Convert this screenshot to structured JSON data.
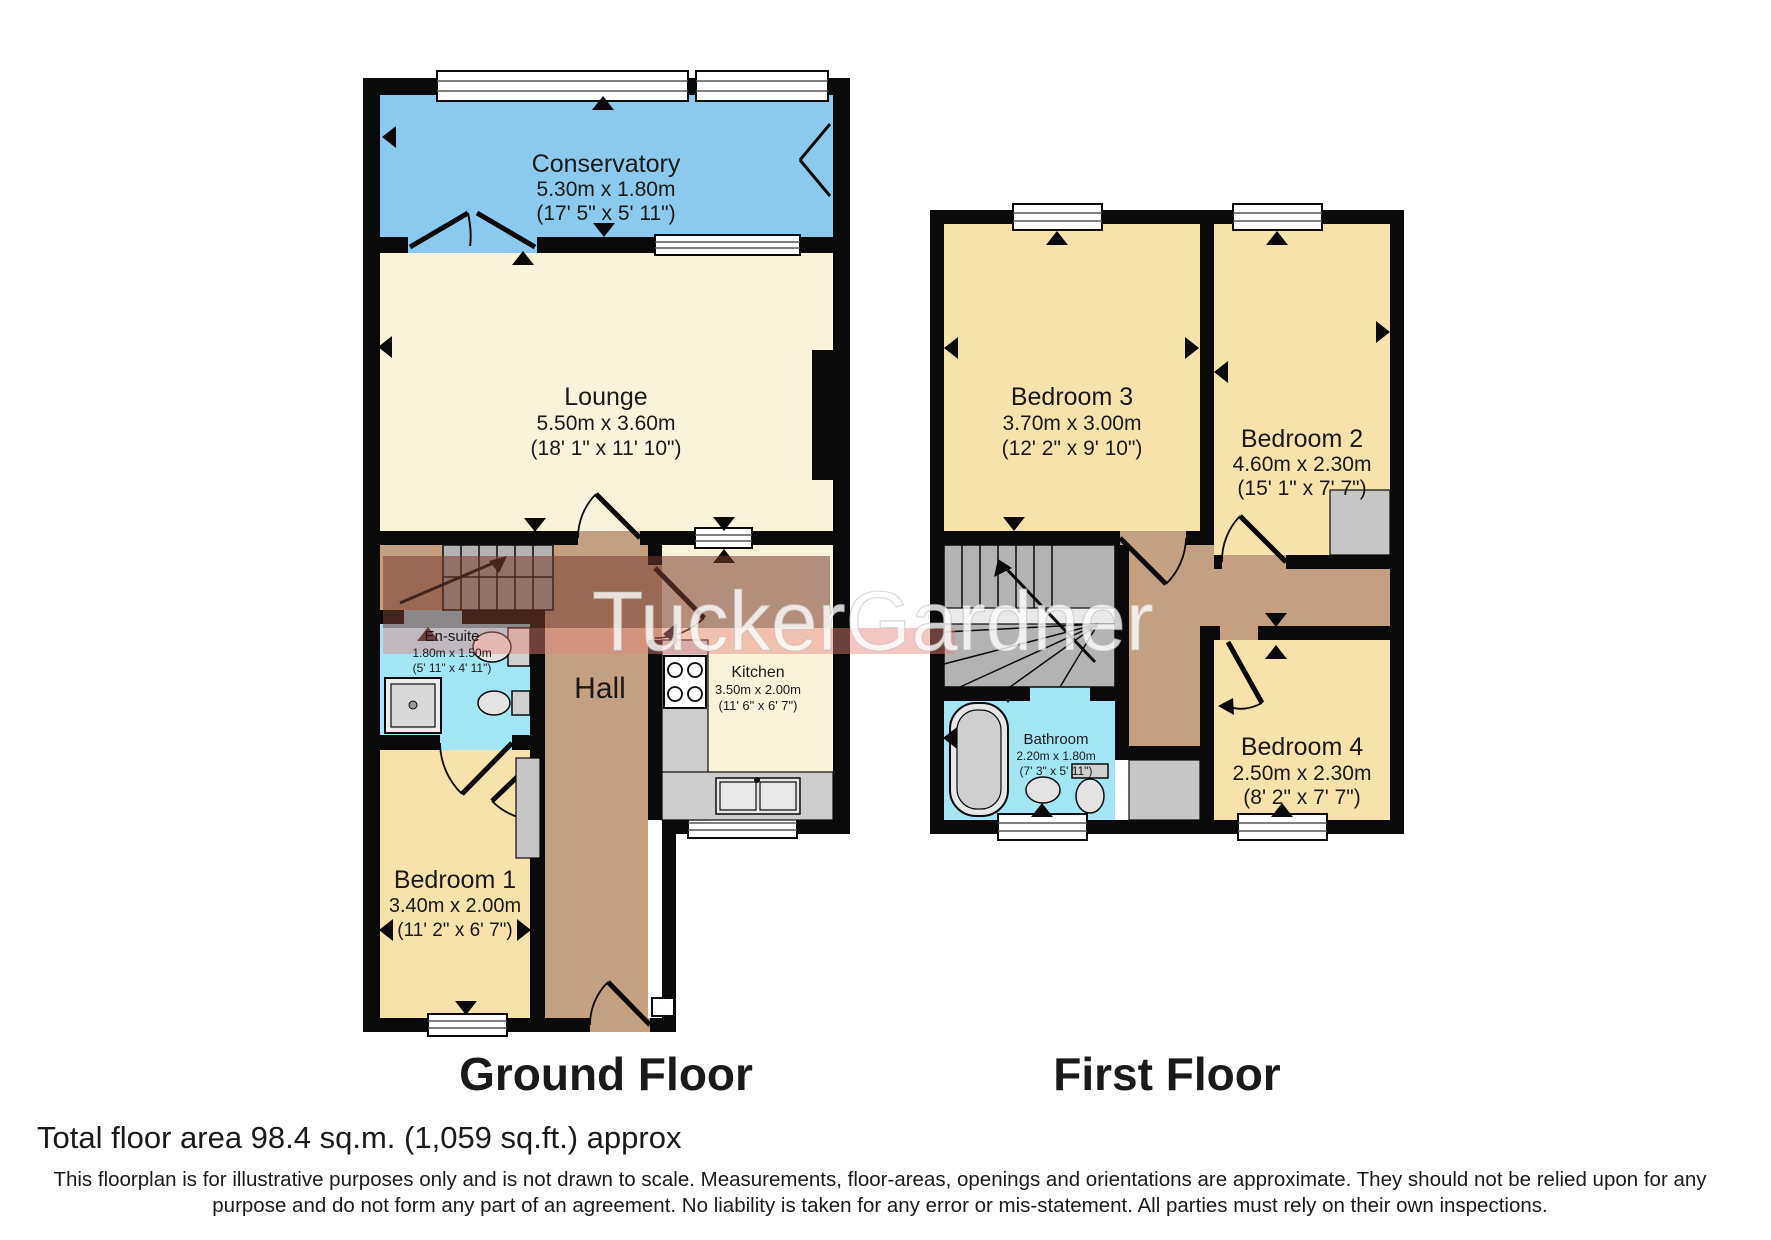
{
  "watermark": {
    "text": "TuckerGardner"
  },
  "ground": {
    "title": "Ground Floor",
    "rooms": {
      "conservatory": {
        "name": "Conservatory",
        "metric": "5.30m x 1.80m",
        "imperial": "(17' 5\" x 5' 11\")"
      },
      "lounge": {
        "name": "Lounge",
        "metric": "5.50m x 3.60m",
        "imperial": "(18' 1\" x 11' 10\")"
      },
      "hall": {
        "name": "Hall"
      },
      "ensuite": {
        "name": "En-suite",
        "metric": "1.80m x 1.50m",
        "imperial": "(5' 11\" x 4' 11\")"
      },
      "kitchen": {
        "name": "Kitchen",
        "metric": "3.50m x 2.00m",
        "imperial": "(11' 6\" x 6' 7\")"
      },
      "bedroom1": {
        "name": "Bedroom 1",
        "metric": "3.40m x 2.00m",
        "imperial": "(11' 2\" x 6' 7\")"
      }
    }
  },
  "first": {
    "title": "First Floor",
    "rooms": {
      "bedroom3": {
        "name": "Bedroom 3",
        "metric": "3.70m x 3.00m",
        "imperial": "(12' 2\" x 9' 10\")"
      },
      "bedroom2": {
        "name": "Bedroom 2",
        "metric": "4.60m x 2.30m",
        "imperial": "(15' 1\" x 7' 7\")"
      },
      "bathroom": {
        "name": "Bathroom",
        "metric": "2.20m x 1.80m",
        "imperial": "(7' 3\" x 5' 11\")"
      },
      "bedroom4": {
        "name": "Bedroom 4",
        "metric": "2.50m x 2.30m",
        "imperial": "(8' 2\" x 7' 7\")"
      }
    }
  },
  "footer": {
    "total_area": "Total floor area 98.4 sq.m. (1,059 sq.ft.) approx",
    "disclaimer_line1": "This floorplan is for illustrative purposes only and is not drawn to scale. Measurements, floor-areas, openings and orientations are approximate. They should not be relied upon for any",
    "disclaimer_line2": "purpose and do not form any part of an agreement. No liability is taken for any error or mis-statement. All parties must rely on their own inspections."
  },
  "colors": {
    "wall": "#0a0a0a",
    "conservatory_blue": "#8bc9ee",
    "living_cream": "#faf3dc",
    "bedroom_yellow": "#f6e2ab",
    "wet_room_cyan": "#a2e6f6",
    "hall_tan": "#c3a07f",
    "stairs_gray": "#b3b3b3",
    "fixture_gray": "#cdcdcd",
    "watermark_maroon": "rgba(120,58,48,0.55)",
    "watermark_pink": "rgba(228,130,125,0.45)"
  }
}
